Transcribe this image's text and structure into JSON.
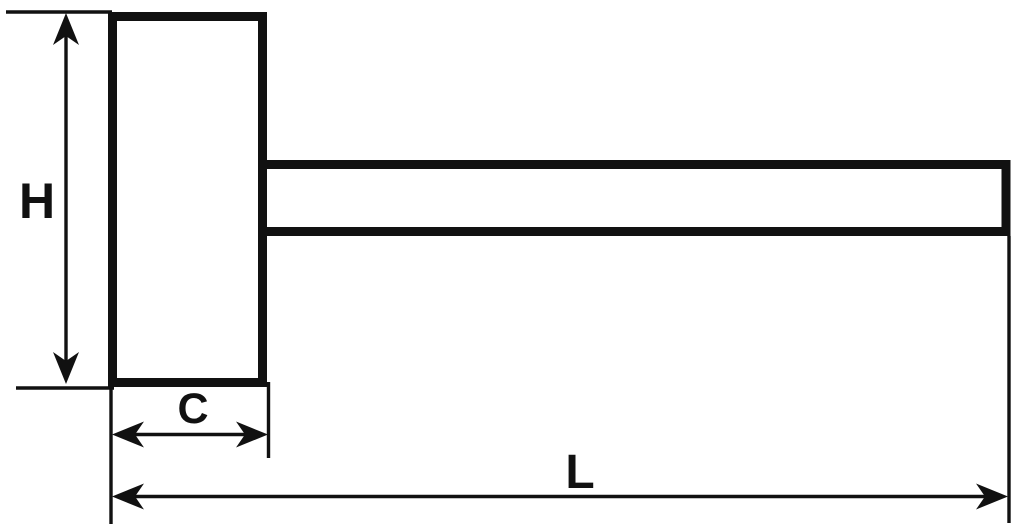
{
  "diagram": {
    "labels": {
      "height": "H",
      "head_width": "C",
      "overall_length": "L"
    },
    "colors": {
      "ink": "#111111",
      "background": "#ffffff"
    }
  }
}
